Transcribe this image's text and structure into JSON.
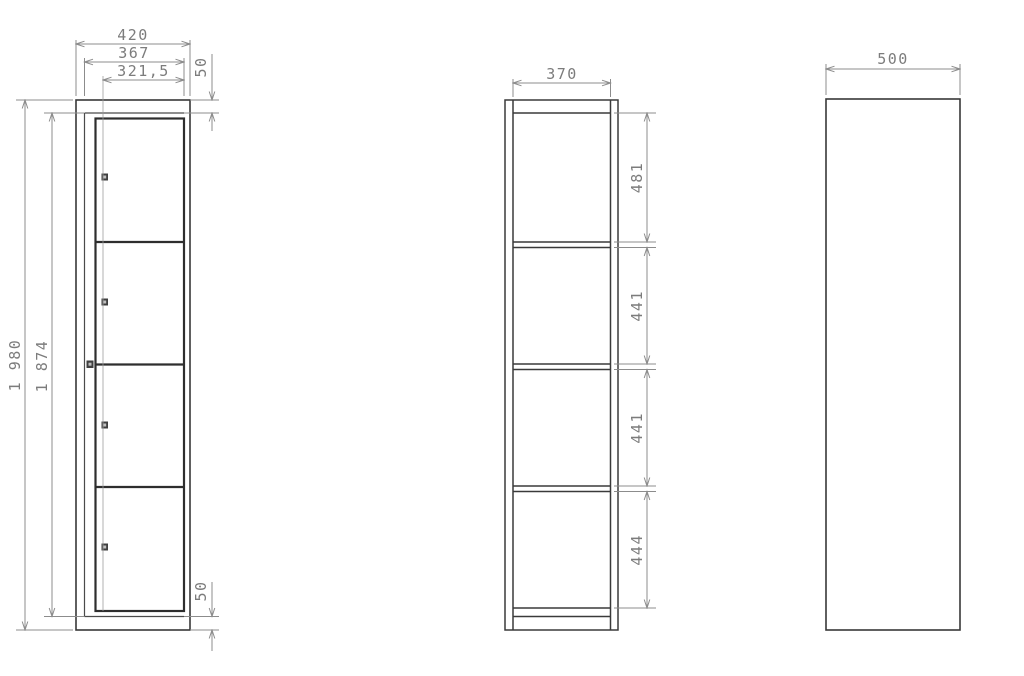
{
  "drawing": {
    "type": "technical-drawing",
    "subject": "four-door locker cabinet, three orthographic views",
    "units": "mm",
    "colors": {
      "background": "#ffffff",
      "object_line": "#383838",
      "dimension_line": "#8c8c8c",
      "dimension_text": "#7c7c7c"
    },
    "views": {
      "front": {
        "label": "front view with four locker doors",
        "door_count": 4,
        "dimensions": {
          "overall_width": "420",
          "frame_width": "367",
          "door_width": "321,5",
          "top_margin": "50",
          "overall_height": "1 980",
          "inner_height": "1 874",
          "bottom_margin": "50"
        }
      },
      "section": {
        "label": "vertical section with four compartments",
        "dimensions": {
          "inner_width": "370",
          "compartments": [
            "481",
            "441",
            "441",
            "444"
          ]
        }
      },
      "side": {
        "label": "side view",
        "dimensions": {
          "depth": "500"
        }
      }
    }
  }
}
